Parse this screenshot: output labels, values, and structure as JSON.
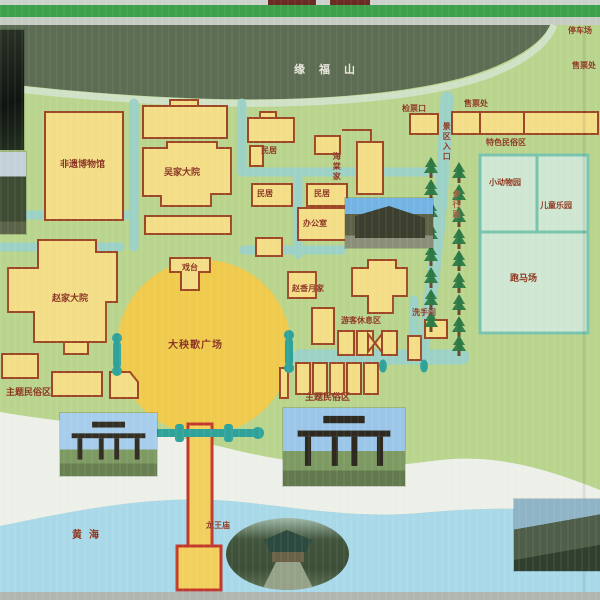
{
  "map_sign": {
    "labels": {
      "mountain": "缘福山",
      "parking": "停车场",
      "ticket_right": "售票处",
      "ticket_check": "检票口",
      "ticket_office": "售票处",
      "entrance": "景区入口",
      "walk_road": "步行路",
      "folk_area": "特色民俗区",
      "zoo": "小动物园",
      "children_park": "儿童乐园",
      "horse_ground": "跑马场",
      "haitang_home": "海棠家",
      "minju_1": "民居",
      "minju_2": "民居",
      "minju_3": "民居",
      "office": "办公室",
      "museum": "非遗博物馆",
      "wu_courtyard": "吴家大院",
      "zhao_courtyard": "赵家大院",
      "stage": "戏台",
      "yangge_square": "大秧歌广场",
      "zhaoxiangyue_home": "赵香月家",
      "rest_area": "游客休息区",
      "toilet": "洗手间",
      "theme_folk_left": "主题民俗区",
      "theme_folk_right": "主题民俗区",
      "yellow_sea": "黄海",
      "dragon_temple": "龙王庙"
    },
    "colors": {
      "map_background": "#b9d48d",
      "mountain": "#5c6d53",
      "building_fill": "#f3dd87",
      "building_border": "#9e4726",
      "road": "#9cd1c6",
      "square_circle": "#efca4c",
      "sea": "#a9d9e9",
      "beach": "#edefe9",
      "label_text": "#8b341c",
      "mountain_text": "#e9e6dc",
      "tree": "#2e7a44",
      "frame_green": "#3da04b",
      "teal_area_border": "#79c4ae",
      "teal_area_fill": "#cfe7d2",
      "pier_fill": "#f2d05e",
      "pier_border": "#c2392b",
      "gate_marker": "#2fa39a"
    }
  }
}
